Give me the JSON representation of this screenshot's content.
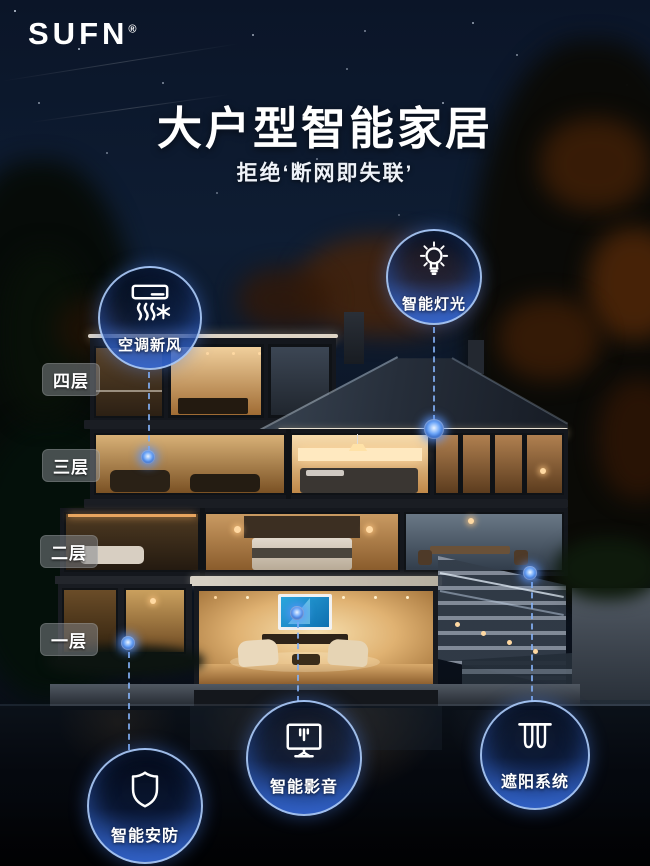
{
  "brand": {
    "name": "SUFN",
    "registered_mark": "®"
  },
  "header": {
    "title": "大户型智能家居",
    "subtitle": "拒绝‘断网即失联’"
  },
  "floor_labels": [
    {
      "label": "四层"
    },
    {
      "label": "三层"
    },
    {
      "label": "二层"
    },
    {
      "label": "一层"
    }
  ],
  "features": [
    {
      "label": "空调新风",
      "icon": "air-conditioner-fresh-air-icon"
    },
    {
      "label": "智能灯光",
      "icon": "light-bulb-icon"
    },
    {
      "label": "智能安防",
      "icon": "shield-icon"
    },
    {
      "label": "智能影音",
      "icon": "tv-media-icon"
    },
    {
      "label": "遮阳系统",
      "icon": "curtain-icon"
    }
  ],
  "colors": {
    "accent_blue": "#3f79e8",
    "badge_ring": "#aacaf8",
    "warm_light": "#ffd9a2",
    "sky_top": "#0b1528"
  }
}
